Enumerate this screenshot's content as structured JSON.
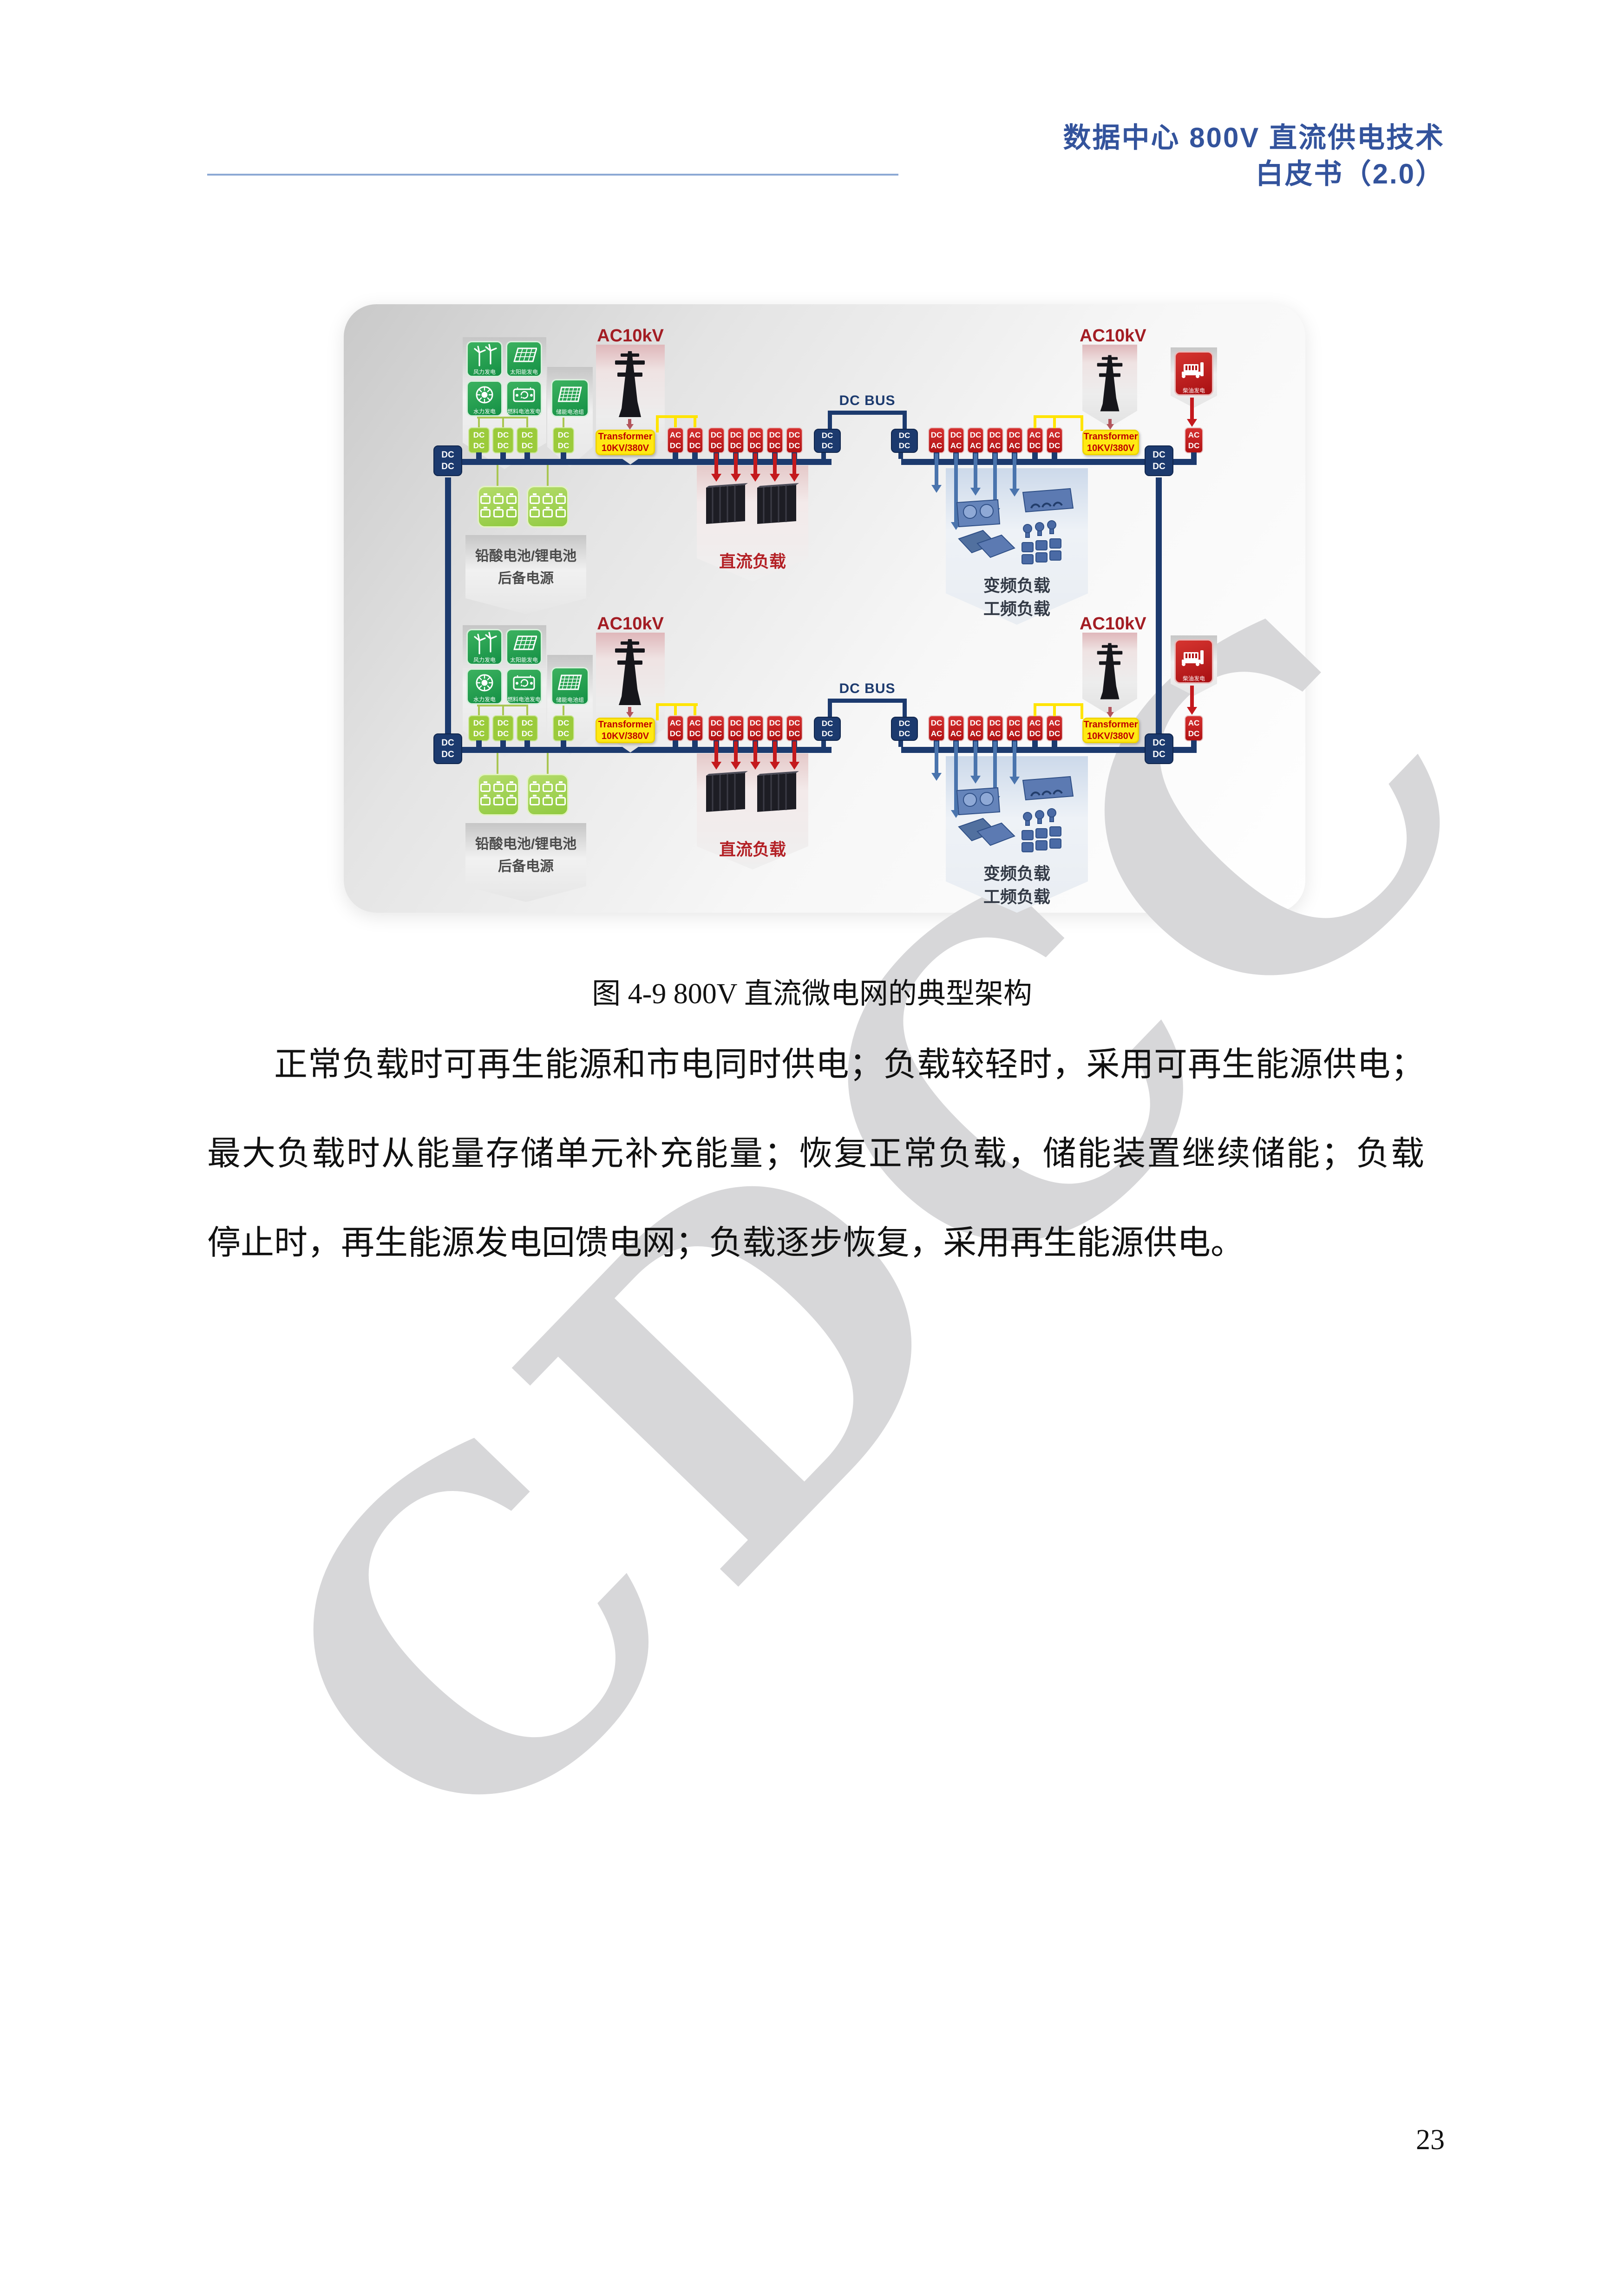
{
  "header": {
    "line1": "数据中心 800V 直流供电技术",
    "line2": "白皮书（2.0）"
  },
  "figure": {
    "caption": "图 4-9 800V 直流微电网的典型架构",
    "row": {
      "ac10kv": "AC10kV",
      "transformer_line1": "Transformer",
      "transformer_line2": "10KV/380V",
      "dc_bus": "DC BUS",
      "ac": "AC",
      "dc": "DC",
      "gen_tiles": [
        {
          "label": "风力发电"
        },
        {
          "label": "太阳能发电"
        },
        {
          "label": "水力发电"
        },
        {
          "label": "燃料电池发电"
        },
        {
          "label": "储能电池组"
        }
      ],
      "battery_label_line1": "铅酸电池/锂电池",
      "battery_label_line2": "后备电源",
      "dc_load_label": "直流负载",
      "ac_load_label_line1": "变频负载",
      "ac_load_label_line2": "工频负载",
      "diesel_label": "柴油发电"
    }
  },
  "body": {
    "line1": "正常负载时可再生能源和市电同时供电；负载较轻时，采用可再生能源供电；",
    "line2": "最大负载时从能量存储单元补充能量；恢复正常负载，储能装置继续储能；负载",
    "line3": "停止时，再生能源发电回馈电网；负载逐步恢复，采用再生能源供电。"
  },
  "watermark": "CDCC",
  "page_number": "23"
}
